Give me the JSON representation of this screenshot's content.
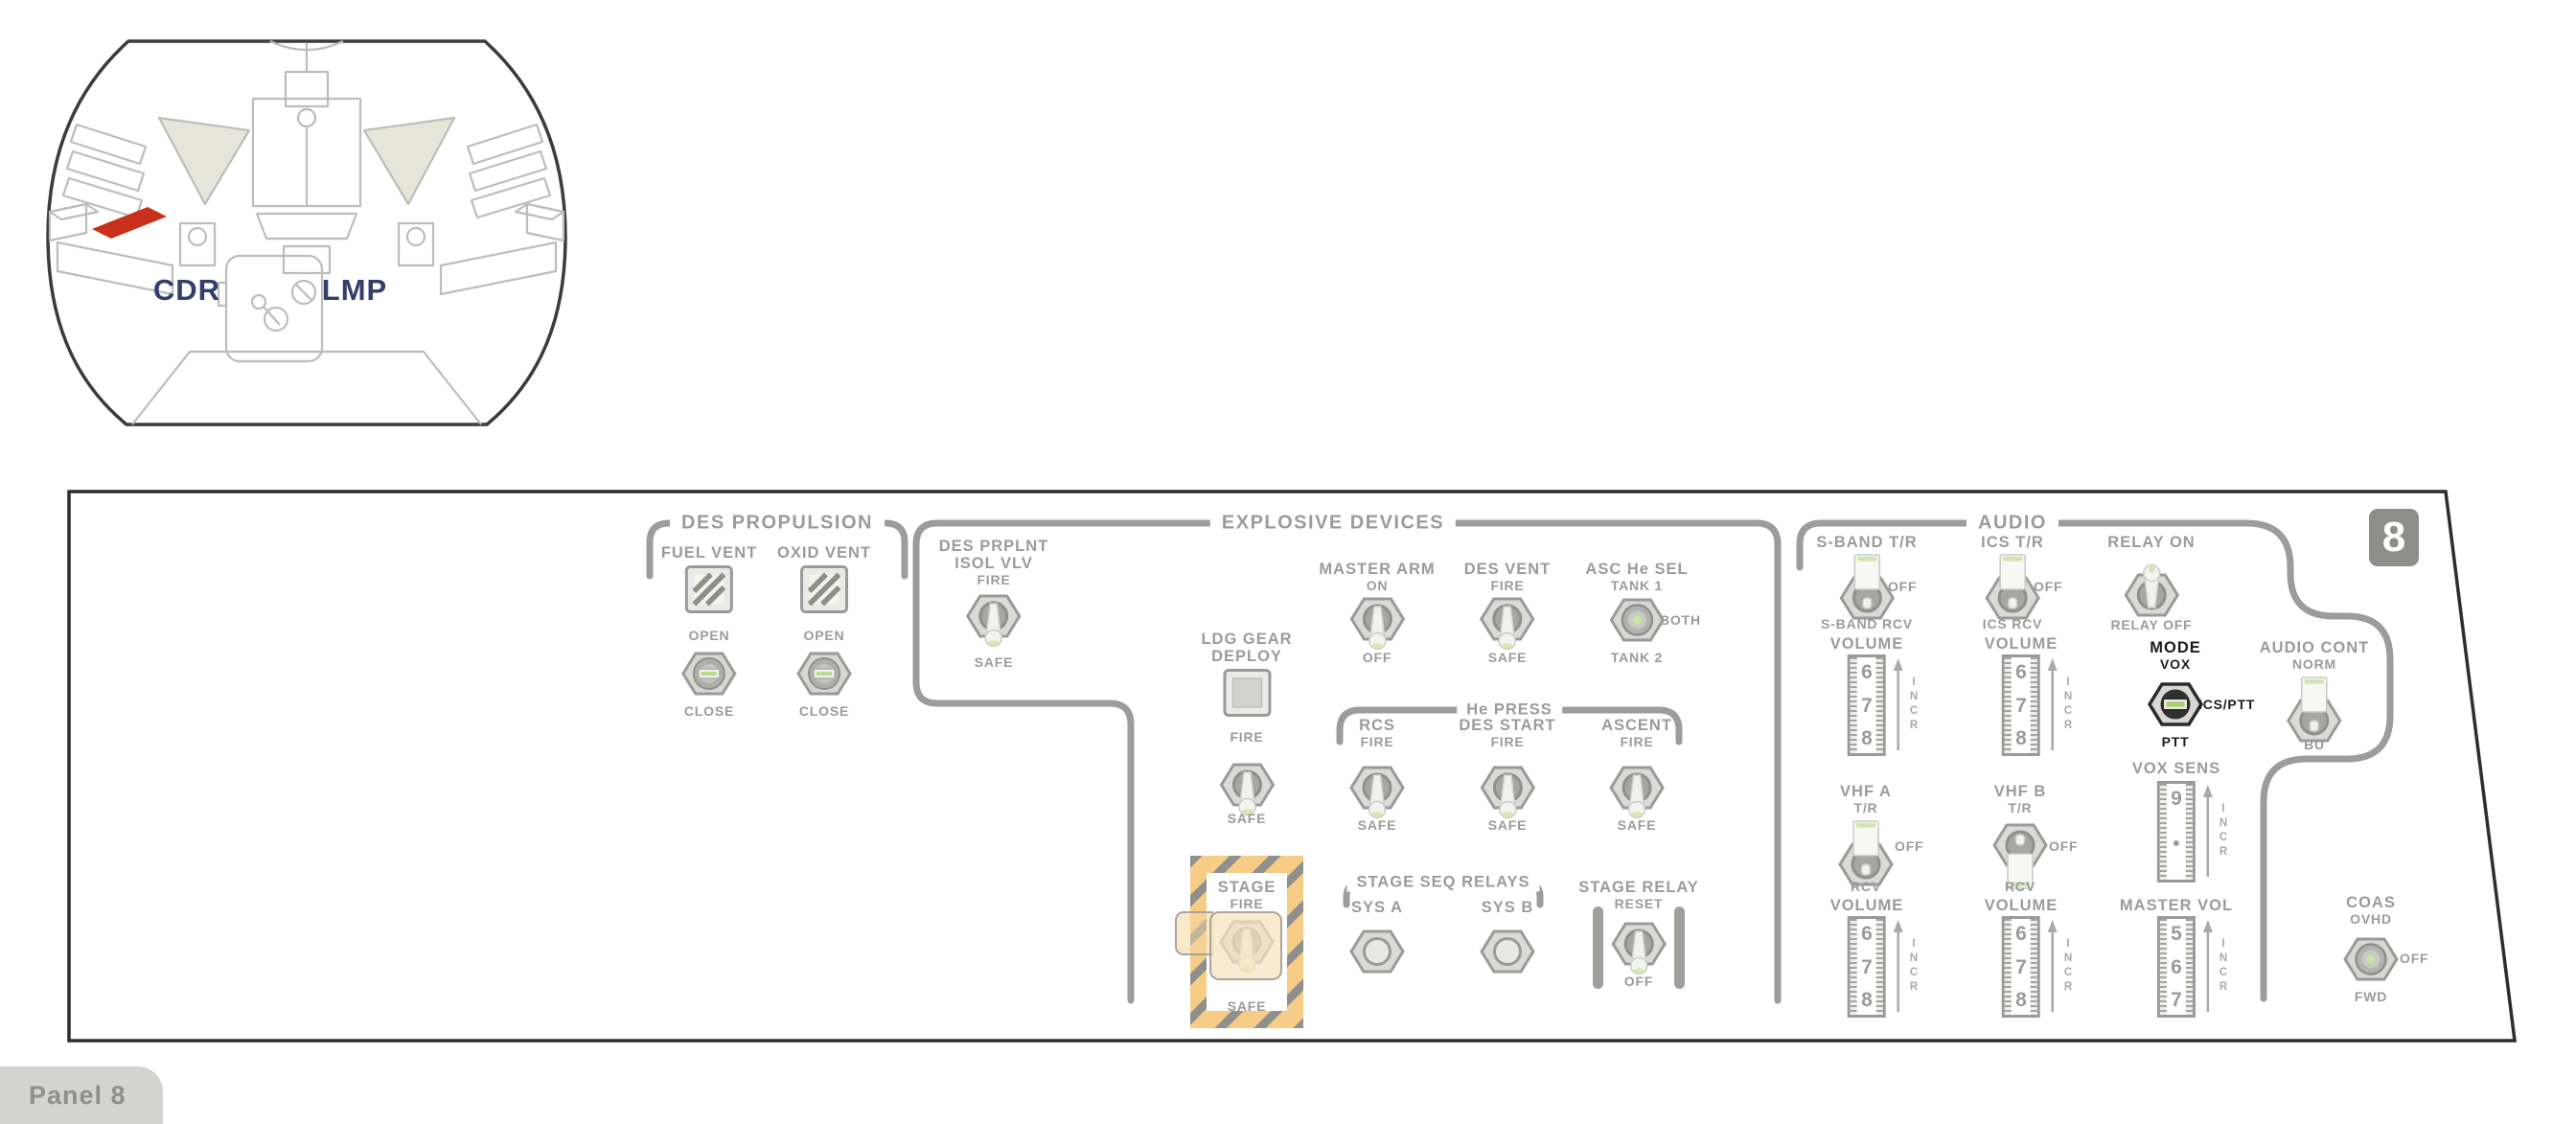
{
  "inset": {
    "left_label": "CDR",
    "right_label": "LMP"
  },
  "badge": "8",
  "tab": "Panel 8",
  "colors": {
    "highlight_red": "#c9301b",
    "hazard_orange": "#f6cc86",
    "line_gray": "#9a9a9a",
    "label_navy": "#333d6e"
  },
  "des_prop": {
    "title": "DES PROPULSION",
    "fuel_vent": {
      "label": "FUEL VENT",
      "open": "OPEN",
      "close": "CLOSE"
    },
    "oxid_vent": {
      "label": "OXID VENT",
      "open": "OPEN",
      "close": "CLOSE"
    }
  },
  "expl": {
    "title": "EXPLOSIVE DEVICES",
    "des_prplnt": {
      "l1": "DES PRPLNT",
      "l2": "ISOL VLV",
      "top": "FIRE",
      "bottom": "SAFE"
    },
    "master_arm": {
      "label": "MASTER ARM",
      "top": "ON",
      "bottom": "OFF"
    },
    "des_vent": {
      "label": "DES VENT",
      "top": "FIRE",
      "bottom": "SAFE"
    },
    "asc_he_sel": {
      "label": "ASC He SEL",
      "top": "TANK 1",
      "right": "BOTH",
      "bottom": "TANK 2"
    },
    "ldg_gear": {
      "l1": "LDG GEAR",
      "l2": "DEPLOY",
      "top": "FIRE",
      "bottom": "SAFE"
    },
    "he_press": {
      "title": "He PRESS",
      "rcs": {
        "label": "RCS",
        "top": "FIRE",
        "bottom": "SAFE"
      },
      "des_start": {
        "label": "DES START",
        "top": "FIRE",
        "bottom": "SAFE"
      },
      "ascent": {
        "label": "ASCENT",
        "top": "FIRE",
        "bottom": "SAFE"
      }
    },
    "stage": {
      "label": "STAGE",
      "top": "FIRE",
      "bottom": "SAFE"
    },
    "stage_seq": {
      "title": "STAGE SEQ RELAYS",
      "sys_a": "SYS A",
      "sys_b": "SYS B"
    },
    "stage_relay": {
      "label": "STAGE RELAY",
      "top": "RESET",
      "bottom": "OFF"
    }
  },
  "audio": {
    "title": "AUDIO",
    "s_band": {
      "label": "S-BAND T/R",
      "right": "OFF",
      "bottom": "S-BAND RCV"
    },
    "ics": {
      "label": "ICS T/R",
      "right": "OFF",
      "bottom": "ICS RCV"
    },
    "relay": {
      "top": "RELAY ON",
      "bottom": "RELAY OFF"
    },
    "vol_sband": {
      "label": "VOLUME",
      "numbers": [
        "6",
        "7",
        "8"
      ],
      "incr": "INCR"
    },
    "vol_ics": {
      "label": "VOLUME",
      "numbers": [
        "6",
        "7",
        "8"
      ],
      "incr": "INCR"
    },
    "mode": {
      "label": "MODE",
      "top": "VOX",
      "right": "ICS/PTT",
      "bottom": "PTT"
    },
    "audio_cont": {
      "label": "AUDIO CONT",
      "top": "NORM",
      "bottom": "BU"
    },
    "vox_sens": {
      "label": "VOX SENS",
      "numbers": [
        "9",
        "●",
        ""
      ],
      "incr": "INCR"
    },
    "vhf_a": {
      "label": "VHF A",
      "top": "T/R",
      "right": "OFF",
      "bottom": "RCV"
    },
    "vhf_b": {
      "label": "VHF B",
      "top": "T/R",
      "right": "OFF",
      "bottom": "RCV"
    },
    "vol_vhf_a": {
      "label": "VOLUME",
      "numbers": [
        "6",
        "7",
        "8"
      ],
      "incr": "INCR"
    },
    "vol_vhf_b": {
      "label": "VOLUME",
      "numbers": [
        "6",
        "7",
        "8"
      ],
      "incr": "INCR"
    },
    "master_vol": {
      "label": "MASTER VOL",
      "numbers": [
        "5",
        "6",
        "7"
      ],
      "incr": "INCR"
    },
    "coas": {
      "label": "COAS",
      "top": "OVHD",
      "right": "OFF",
      "bottom": "FWD"
    }
  }
}
